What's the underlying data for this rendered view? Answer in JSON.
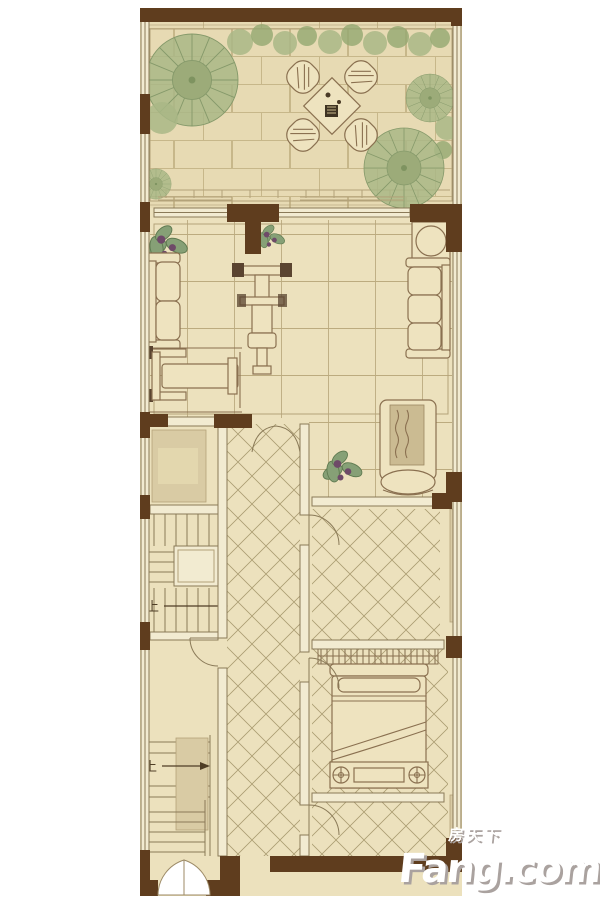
{
  "plan": {
    "kind": "residential floor plan (one level of a townhouse with front terrace)",
    "labels": {
      "stair_up_upper": "上",
      "stair_up_lower": "上"
    },
    "icons": {
      "palm_tree": "palm-tree-top-view",
      "shrubs": "shrub-row",
      "patio_set": "square-table-with-four-chairs",
      "sofa_left": "two-seat-sofa",
      "sofa_right": "three-seat-sofa",
      "round_table": "round-corner-table",
      "gym_machine": "exercise-machine",
      "exercise_bench": "exercise-bench",
      "chaise": "chaise-lounge",
      "potted_plant": "potted-plant",
      "bed": "double-bed-with-bench",
      "wardrobe": "wardrobe-hanging-clothes",
      "stairs": "staircase-with-up-arrow",
      "double_door": "double-swing-entry-door",
      "arch": "arched-opening"
    },
    "colors": {
      "wall": "#5f3d1e",
      "floor": "#ece1bd",
      "terrace": "#e7dab3",
      "brick-line": "#c7b78a",
      "grid-line": "#bcab7f",
      "tile-line": "#ab9d72",
      "wall-line": "#8a7a58",
      "furniture-line": "#8a7050",
      "furniture-fill": "#eee3bf",
      "bay": "#d9cba4",
      "tree": "#a9b786",
      "tree-dark": "#85996a",
      "flower": "#6e4a68",
      "wm-color": "#ffffff",
      "wm-shadow": "#aaa29f"
    }
  },
  "watermark": {
    "cjk": "房天下",
    "brand": "Fang.com"
  }
}
